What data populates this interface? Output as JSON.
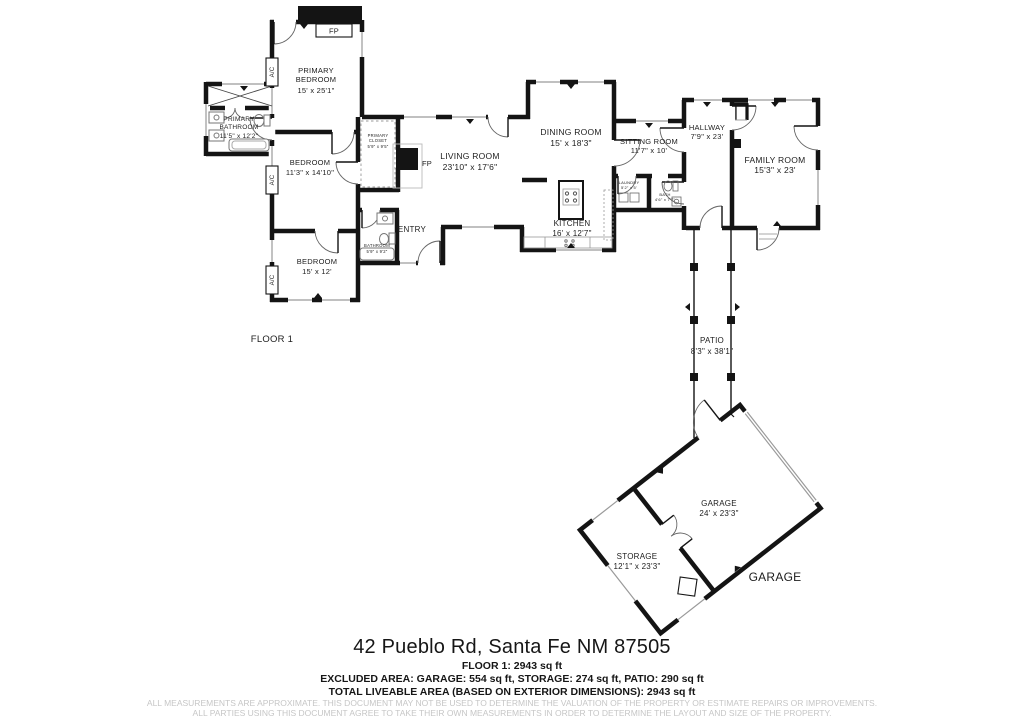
{
  "rooms": [
    {
      "id": "primary-bedroom",
      "line1": "PRIMARY",
      "line2": "BEDROOM",
      "dims": "15' x 25'1\""
    },
    {
      "id": "primary-bathroom",
      "line1": "PRIMARY",
      "line2": "BATHROOM",
      "dims": "11'5\" x 12'2\""
    },
    {
      "id": "bedroom-north",
      "line1": "BEDROOM",
      "dims": "11'3\" x 14'10\""
    },
    {
      "id": "primary-closet",
      "line1": "PRIMARY",
      "line2": "CLOSET",
      "dims": "5'9\" x 9'5\""
    },
    {
      "id": "bedroom-south",
      "line1": "BEDROOM",
      "dims": "15' x 12'"
    },
    {
      "id": "bathroom",
      "line1": "BATHROOM",
      "dims": "5'9\" x 9'2\""
    },
    {
      "id": "living-room",
      "line1": "LIVING ROOM",
      "dims": "23'10\" x 17'6\""
    },
    {
      "id": "entry",
      "line1": "ENTRY"
    },
    {
      "id": "dining-room",
      "line1": "DINING ROOM",
      "dims": "15' x 18'3\""
    },
    {
      "id": "kitchen",
      "line1": "KITCHEN",
      "dims": "16' x 12'7\""
    },
    {
      "id": "sitting-room",
      "line1": "SITTING ROOM",
      "dims": "11'7\" x 10'"
    },
    {
      "id": "laundry",
      "line1": "LAUNDRY",
      "dims": "5'2\" x 5'"
    },
    {
      "id": "bath",
      "line1": "BATH",
      "dims": "4'6\" x 7'7\""
    },
    {
      "id": "hallway",
      "line1": "HALLWAY",
      "dims": "7'9\" x 23'"
    },
    {
      "id": "family-room",
      "line1": "FAMILY ROOM",
      "dims": "15'3\" x 23'"
    },
    {
      "id": "patio",
      "line1": "PATIO",
      "dims": "8'3\" x 38'1\""
    },
    {
      "id": "garage",
      "line1": "GARAGE",
      "dims": "24' x 23'3\""
    },
    {
      "id": "storage",
      "line1": "STORAGE",
      "dims": "12'1\" x 23'3\""
    }
  ],
  "annotations": {
    "fireplace": "FP",
    "ac_unit": "A/C",
    "garage_wing": "GARAGE",
    "floor_label": "FLOOR 1"
  },
  "footer": {
    "address": "42 Pueblo Rd, Santa Fe NM 87505",
    "floor_area": "FLOOR 1: 2943 sq ft",
    "excluded_area": "EXCLUDED AREA: GARAGE: 554 sq ft, STORAGE: 274 sq ft, PATIO: 290 sq ft",
    "total_area": "TOTAL LIVEABLE AREA (BASED ON EXTERIOR DIMENSIONS): 2943 sq ft",
    "disclaimer_line1": "ALL MEASUREMENTS ARE APPROXIMATE. THIS DOCUMENT MAY NOT BE USED TO DETERMINE THE VALUATION OF THE PROPERTY OR ESTIMATE REPAIRS OR IMPROVEMENTS.",
    "disclaimer_line2": "ALL PARTIES USING THIS DOCUMENT AGREE TO TAKE THEIR OWN MEASUREMENTS IN ORDER TO DETERMINE THE LAYOUT AND SIZE OF THE PROPERTY."
  },
  "colors": {
    "wall": "#141414",
    "window": "#9a9a9a",
    "label": "#1d1d1d",
    "disclaimer": "#c6c6c6"
  }
}
